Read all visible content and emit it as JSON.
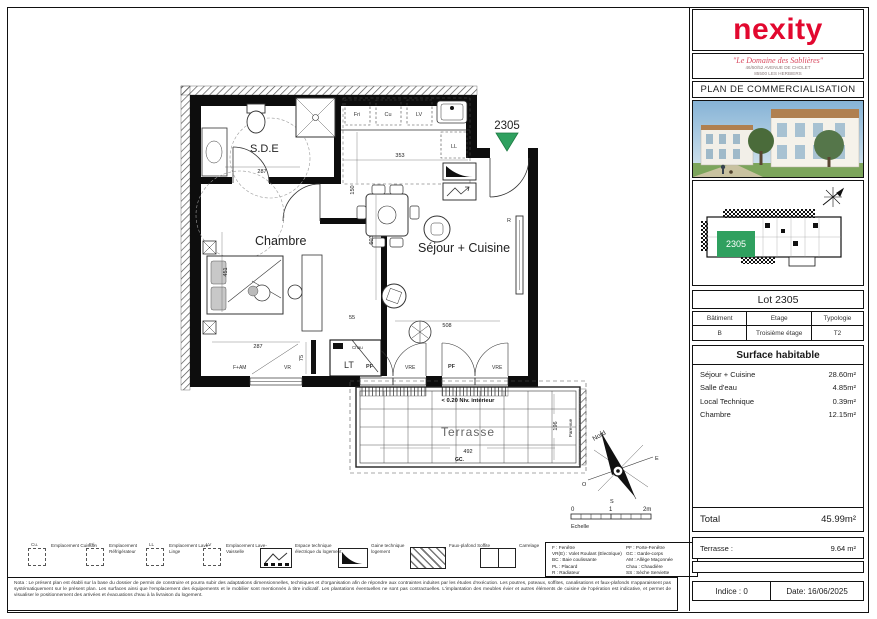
{
  "brand": {
    "logo_text": "nexity",
    "brand_red": "#e2082f",
    "accent_green": "#2fa05f"
  },
  "header": {
    "project_name": "\"Le Domaine des Sablières\"",
    "address_line1": "46/50/52 AVENUE DE CHOLET",
    "address_line2": "85500 LES HERBIERS",
    "doc_title": "PLAN DE COMMERCIALISATION"
  },
  "lot_info": {
    "title": "Lot 2305",
    "col1_header": "Bâtiment",
    "col2_header": "Etage",
    "col3_header": "Typologie",
    "col1_value": "B",
    "col2_value": "Troisième étage",
    "col3_value": "T2"
  },
  "surfaces": {
    "title": "Surface habitable",
    "rows": [
      {
        "label": "Séjour + Cuisine",
        "value": "28.60m²"
      },
      {
        "label": "Salle d'eau",
        "value": "4.85m²"
      },
      {
        "label": "Local Technique",
        "value": "0.39m²"
      },
      {
        "label": "Chambre",
        "value": "12.15m²"
      }
    ],
    "total_label": "Total",
    "total_value": "45.99m²",
    "terrace_label": "Terrasse :",
    "terrace_value": "9.64 m²"
  },
  "revision": {
    "indice": "Indice : 0",
    "date": "Date: 16/06/2025"
  },
  "plan": {
    "lot_marker": "2305",
    "site_lot": "2305",
    "rooms": {
      "sde": "S.D.E",
      "chambre": "Chambre",
      "sejour": "Séjour + Cuisine",
      "terrasse": "Terrasse"
    },
    "annotations": {
      "niveau": "< 0.20 Niv. intérieur",
      "gc": "GC.",
      "pare_vue": "Pare-vue",
      "north": "Nord",
      "east": "E",
      "west": "O",
      "south": "S",
      "scale_0": "0",
      "scale_1": "1",
      "scale_2": "2m",
      "scale_label": "Echelle"
    },
    "tags": {
      "fri": "Fri",
      "cu": "Cu",
      "lv": "LV",
      "ll": "LL",
      "pf1": "PF",
      "vre1": "VRE",
      "pf2": "PF",
      "vre2": "VRE",
      "f_am": "F+AM",
      "vr": "VR",
      "r": "R",
      "lt": "LT",
      "chau": "Chau"
    },
    "dims": {
      "sde_w": "287",
      "kitchen_w": "353",
      "kitchen_d": "150",
      "chambre_l": "451",
      "chambre_w": "287",
      "d55": "55",
      "sejour_w": "508",
      "sejour_l": "603",
      "d75": "75",
      "terrasse_w": "492",
      "terrasse_d": "196"
    }
  },
  "legend": {
    "items": [
      {
        "tag": "Cu.",
        "caption": "Emplacement Cuisson"
      },
      {
        "tag": "Fri.",
        "caption": "Emplacement Réfrigérateur"
      },
      {
        "tag": "LL",
        "caption": "Emplacement Lave-Linge"
      },
      {
        "tag": "LV",
        "caption": "Emplacement Lave-Vaisselle"
      }
    ],
    "tech_caption": "Espace technique électrique du logement",
    "gaine_caption": "Gaine technique logement",
    "soffit_caption": "Faux-plafond Soffite",
    "tile_caption": "Carrelage",
    "abbrev_col1": [
      "F : Fenêtre",
      "VR(E) : Volet Roulant (Electrique)",
      "BC : Baie coulissante",
      "PL : Placard",
      "R : Radiateur"
    ],
    "abbrev_col2": [
      "PF : Porte-Fenêtre",
      "GC : Garde-corps",
      "AM : Allège Maçonnée",
      "Chau : Chaudière",
      "SS : Sèche Serviette"
    ]
  },
  "notes": "Nota : Le présent plan est établi sur la base du dossier de permis de construire et pourra subir des adaptations dimensionnelles, techniques et d'organisation afin de répondre aux contraintes induites par les études d'exécution. Les poutres, poteaux, soffites, canalisations et faux-plafonds n'apparaissent pas systématiquement sur le présent plan. Les surfaces ainsi que l'emplacement des équipements et le mobilier sont mentionnés à titre indicatif. Les plantations éventuelles ne sont pas contractuelles. L'implantation des meubles évier et autres éléments de cuisine de l'opération est indicative, et permet de visualiser le positionnement des arrivées et évacuations d'eau à la livraison du logement."
}
